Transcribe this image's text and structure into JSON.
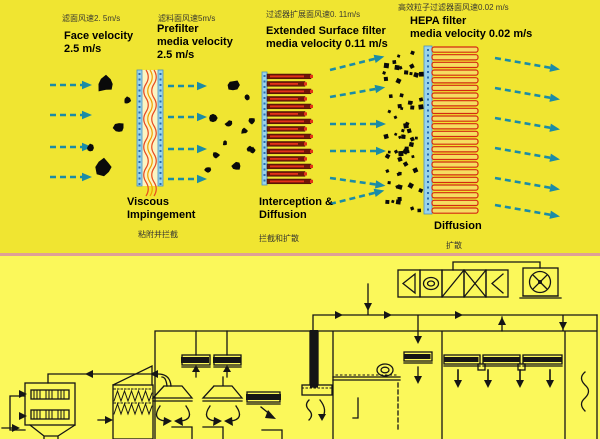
{
  "slide": {
    "background_top": "#F0E531",
    "background_bottom": "#FBF85A",
    "divider_color": "#DFA096"
  },
  "stages": [
    {
      "cn_velocity": "滤面风速2. 5m/s",
      "en_label": "Face velocity\n2.5 m/s"
    },
    {
      "cn_velocity": "滤料面风速5m/s",
      "en_label": "Prefilter\nmedia velocity\n2.5 m/s",
      "mechanism_en": "Viscous\nImpingement",
      "mechanism_cn": "粘附并拦截"
    },
    {
      "cn_velocity": "过滤器扩展面风速0. 11m/s",
      "en_label": "Extended Surface filter\nmedia velocity 0.11 m/s",
      "mechanism_en": "Interception &\nDiffusion",
      "mechanism_cn": "拦截和扩散"
    },
    {
      "cn_velocity": "高效粒子过滤器面风速0.02 m/s",
      "en_label": "HEPA filter\nmedia velocity 0.02 m/s",
      "mechanism_en": "Diffusion",
      "mechanism_cn": "扩散"
    }
  ],
  "figure": {
    "colors": {
      "arrow": "#1B8CA6",
      "particle": "#0A0A0A",
      "media_strip": "#9AD4EA",
      "strip_dot": "#2B6CB0",
      "strip_edge": "#4A90C2",
      "media_fill": "#FCF4C2",
      "fiber1": "#E8491F",
      "fiber2": "#F0A000",
      "pleat_dark": "#701608",
      "pleat_red": "#E23318",
      "hepa_frame": "#D42A10",
      "hepa_fill": "#F6DC60",
      "schematic_line": "#151515"
    },
    "arrow_groups": [
      {
        "name": "inlet-arrows",
        "x1": 50,
        "x2": 82,
        "rows": [
          85,
          115,
          147,
          177
        ],
        "tilt": [
          0,
          0,
          0,
          0
        ]
      },
      {
        "name": "post-prefilter-arrows",
        "x1": 168,
        "x2": 197,
        "rows": [
          86,
          117,
          149,
          179
        ],
        "tilt": [
          0,
          0,
          0,
          0
        ]
      },
      {
        "name": "post-extended-arrows",
        "x1": 330,
        "x2": 376,
        "rows": [
          70,
          97,
          124,
          151,
          178,
          204
        ],
        "tilt": [
          -14,
          -10,
          0,
          0,
          8,
          -14
        ]
      },
      {
        "name": "clean-air-arrows",
        "x1": 495,
        "x2": 551,
        "rows": [
          58,
          88,
          118,
          148,
          178,
          205
        ],
        "tilt": [
          10,
          10,
          10,
          10,
          10,
          10
        ]
      }
    ],
    "particles": {
      "large": [
        [
          106,
          84,
          9
        ],
        [
          119,
          128,
          6
        ],
        [
          104,
          167,
          9
        ],
        [
          90,
          148,
          4
        ],
        [
          127,
          101,
          4
        ]
      ],
      "medium": [
        [
          233,
          85,
          6
        ],
        [
          213,
          118,
          4.5
        ],
        [
          229,
          124,
          4
        ],
        [
          244,
          131,
          3.5
        ],
        [
          216,
          155,
          4
        ],
        [
          236,
          166,
          4.5
        ],
        [
          250,
          149,
          3
        ],
        [
          247,
          97,
          3
        ],
        [
          252,
          121,
          3.5
        ],
        [
          253,
          150,
          3
        ],
        [
          225,
          143,
          2.5
        ],
        [
          208,
          170,
          3.5
        ]
      ],
      "fine": {
        "x0": 384,
        "x1": 422,
        "y0": 52,
        "y1": 212,
        "count": 62,
        "seed": 11,
        "r0": 1.3,
        "r1": 2.5
      }
    },
    "prefilter": {
      "x": 137,
      "y": 70,
      "w": 26,
      "h": 116
    },
    "extended": {
      "x": 262,
      "y": 72,
      "h": 113,
      "pleats": 15,
      "len_a": 44,
      "len_b": 38
    },
    "hepa": {
      "x": 424,
      "y": 46,
      "h": 168,
      "pleats": 22,
      "len": 46
    }
  }
}
